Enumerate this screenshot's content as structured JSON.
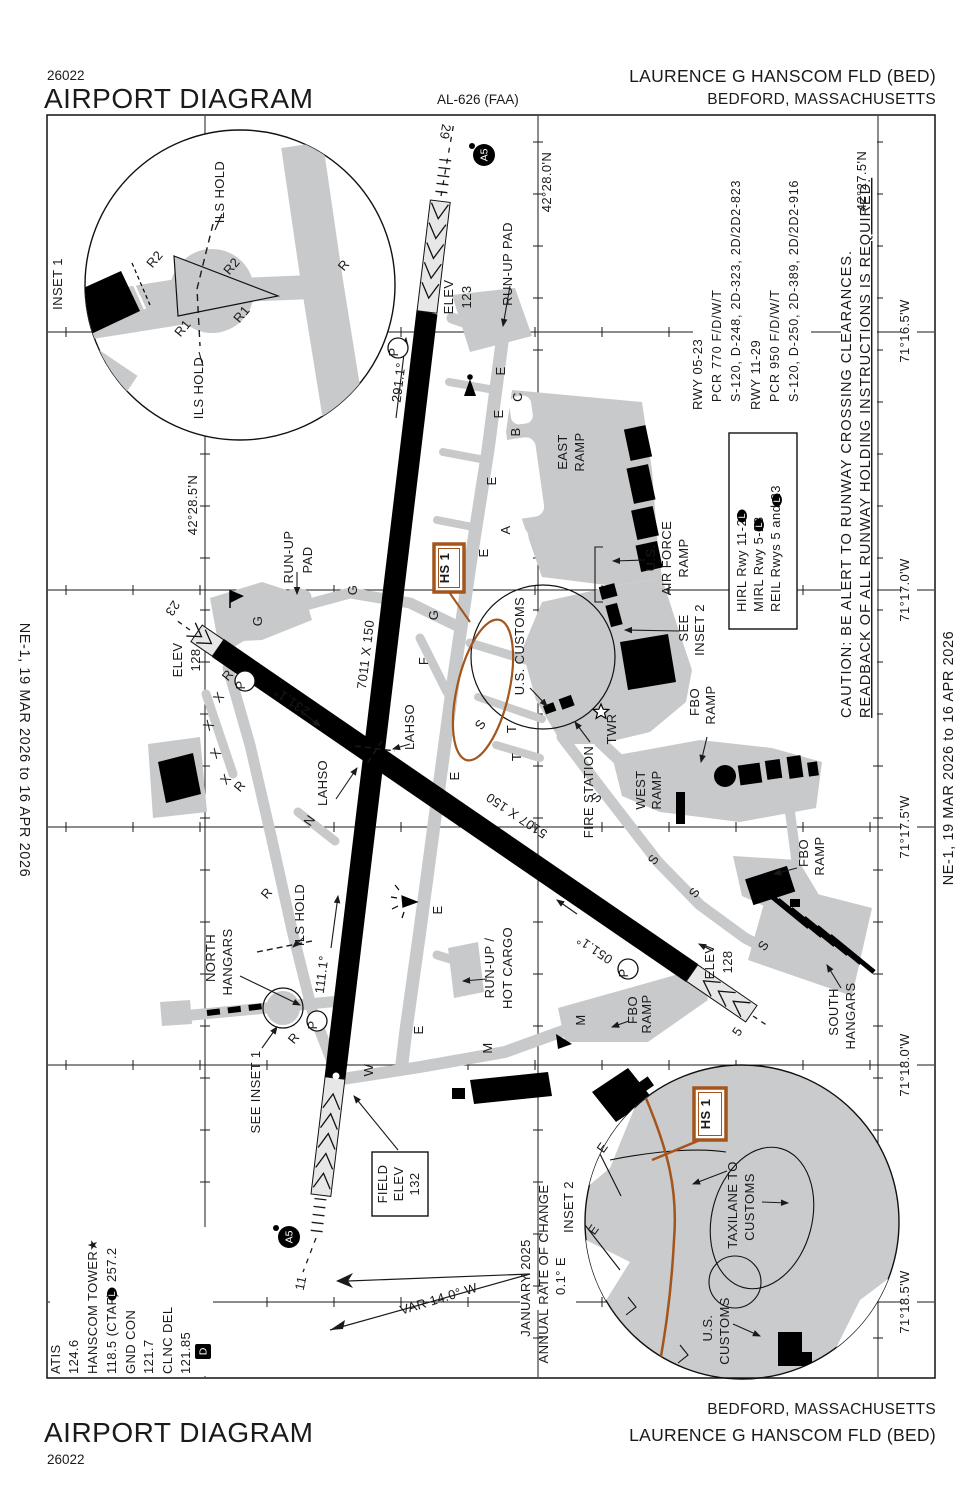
{
  "page": {
    "chart_number": "26022",
    "title": "AIRPORT DIAGRAM",
    "al_number": "AL-626 (FAA)",
    "airport_name": "LAURENCE G HANSCOM FLD (BED)",
    "city": "BEDFORD, MASSACHUSETTS",
    "edition_note": "NE-1,  19 MAR 2026  to  16 APR 2026"
  },
  "runway_data": {
    "rwy1_name": "RWY 05-23",
    "rwy1_pcr": "PCR 770 F/D/W/T",
    "rwy1_strength": "S-120, D-248, 2D-323, 2D/2D2-823",
    "rwy2_name": "RWY 11-29",
    "rwy2_pcr": "PCR 950 F/D/W/T",
    "rwy2_strength": "S-120, D-250, 2D-389, 2D/2D2-916"
  },
  "lighting_box": {
    "line1": "HIRL Rwy 11-29",
    "line2": "MIRL Rwy 5-23",
    "line3": "REIL Rwys 5 and 23"
  },
  "cautions": {
    "line1": "CAUTION: BE ALERT TO RUNWAY CROSSING CLEARANCES.",
    "line2": "READBACK OF ALL RUNWAY HOLDING INSTRUCTIONS IS REQUIRED."
  },
  "comms": {
    "atis_label": "ATIS",
    "atis_freq": "124.6",
    "tower_label": "HANSCOM TOWER★",
    "tower_freq": "118.5 (CTAF)",
    "tower_freq2": "257.2",
    "gnd_label": "GND CON",
    "gnd_freq": "121.7",
    "clnc_label": "CLNC DEL",
    "clnc_freq": "121.85"
  },
  "badges": {
    "a5": "A5",
    "l": "L",
    "d": "D",
    "p": "P"
  },
  "map_labels": [
    {
      "n": "inset1-title",
      "t": "INSET 1",
      "x": 62,
      "y": 284,
      "fs": 14
    },
    {
      "n": "ils-hold-label",
      "t": "ILS HOLD",
      "x": 224,
      "y": 192,
      "fs": 12.5
    },
    {
      "n": "ils-hold-label",
      "t": "ILS HOLD",
      "x": 203,
      "y": 388,
      "fs": 12.5
    },
    {
      "n": "taxiway-label-r2",
      "t": "R2",
      "x": 158,
      "y": 262,
      "r": -50,
      "fs": 12.5
    },
    {
      "n": "taxiway-label-r2",
      "t": "R2",
      "x": 235,
      "y": 269,
      "r": -50,
      "fs": 12.5
    },
    {
      "n": "taxiway-label-r1",
      "t": "R1",
      "x": 186,
      "y": 331,
      "r": -50,
      "fs": 12.5
    },
    {
      "n": "taxiway-label-r1",
      "t": "R1",
      "x": 245,
      "y": 317,
      "r": -50,
      "fs": 12.5
    },
    {
      "n": "taxiway-label-r",
      "t": "R",
      "x": 347,
      "y": 268,
      "r": -50,
      "fs": 12.5
    },
    {
      "n": "runway-29-number",
      "t": "29",
      "x": 441,
      "y": 131,
      "r": 100,
      "fs": 15
    },
    {
      "n": "lat-label",
      "t": "42°28.0'N",
      "x": 551,
      "y": 182,
      "fs": 12.5
    },
    {
      "n": "lat-label",
      "t": "42°28.5'N",
      "x": 197,
      "y": 505,
      "fs": 12.5
    },
    {
      "n": "lat-label",
      "t": "42°27.5'N",
      "x": 866,
      "y": 181,
      "fs": 12.5
    },
    {
      "n": "lon-label",
      "t": "71°16.5'W",
      "x": 909,
      "y": 331,
      "fs": 12.5
    },
    {
      "n": "lon-label",
      "t": "71°17.0'W",
      "x": 909,
      "y": 590,
      "fs": 12.5
    },
    {
      "n": "lon-label",
      "t": "71°17.5'W",
      "x": 909,
      "y": 827,
      "fs": 12.5
    },
    {
      "n": "lon-label",
      "t": "71°18.0'W",
      "x": 909,
      "y": 1065,
      "fs": 12.5
    },
    {
      "n": "lon-label",
      "t": "71°18.5'W",
      "x": 909,
      "y": 1302,
      "fs": 12.5
    },
    {
      "n": "elev-123-label",
      "t": "ELEV",
      "x": 453,
      "y": 297,
      "fs": 12.5
    },
    {
      "n": "elev-123-value",
      "t": "123",
      "x": 471,
      "y": 297,
      "fs": 12.5
    },
    {
      "n": "runup-pad-label",
      "t": "RUN-UP PAD",
      "x": 512,
      "y": 264,
      "fs": 12.5
    },
    {
      "n": "heading-291",
      "t": "291.1°",
      "x": 403,
      "y": 383,
      "r": -83,
      "fs": 12.5
    },
    {
      "n": "runup-pad-label",
      "t": "RUN-UP",
      "x": 293,
      "y": 557,
      "fs": 12.5
    },
    {
      "n": "runup-pad-label",
      "t": "PAD",
      "x": 312,
      "y": 560,
      "fs": 12.5
    },
    {
      "n": "runway-23-number",
      "t": "23",
      "x": 169,
      "y": 606,
      "r": 124,
      "fs": 15
    },
    {
      "n": "elev-128-label",
      "t": "ELEV",
      "x": 182,
      "y": 660,
      "fs": 12.5
    },
    {
      "n": "elev-128-value",
      "t": "128",
      "x": 200,
      "y": 660,
      "fs": 12.5
    },
    {
      "n": "taxiway-label-g",
      "t": "G",
      "x": 262,
      "y": 621
    },
    {
      "n": "taxiway-label-g",
      "t": "G",
      "x": 357,
      "y": 590
    },
    {
      "n": "taxiway-label-g",
      "t": "G",
      "x": 438,
      "y": 615
    },
    {
      "n": "runway-dimensions",
      "t": "7011 X 150",
      "x": 370,
      "y": 655,
      "r": -83,
      "fs": 13
    },
    {
      "n": "heading-231",
      "t": "231.1°",
      "x": 294,
      "y": 698,
      "r": -146,
      "fs": 12.5
    },
    {
      "n": "closed-taxiway-x",
      "t": "X",
      "x": 222,
      "y": 700,
      "r": -50,
      "fs": 12
    },
    {
      "n": "closed-taxiway-x",
      "t": "X",
      "x": 212,
      "y": 728,
      "r": -50,
      "fs": 12
    },
    {
      "n": "closed-taxiway-x",
      "t": "X",
      "x": 219,
      "y": 756,
      "r": -50,
      "fs": 12
    },
    {
      "n": "closed-taxiway-x",
      "t": "X",
      "x": 229,
      "y": 782,
      "r": -50,
      "fs": 12
    },
    {
      "n": "taxiway-label-r",
      "t": "R",
      "x": 231,
      "y": 678,
      "r": -50,
      "fs": 12.5
    },
    {
      "n": "taxiway-label-r",
      "t": "R",
      "x": 243,
      "y": 789,
      "r": -50,
      "fs": 12.5
    },
    {
      "n": "taxiway-label-r",
      "t": "R",
      "x": 270,
      "y": 896,
      "r": -50,
      "fs": 12.5
    },
    {
      "n": "taxiway-label-r",
      "t": "R",
      "x": 297,
      "y": 1041,
      "r": -50,
      "fs": 12.5
    },
    {
      "n": "taxiway-label-e",
      "t": "E",
      "x": 505,
      "y": 371
    },
    {
      "n": "taxiway-label-c",
      "t": "C",
      "x": 522,
      "y": 397
    },
    {
      "n": "taxiway-label-e",
      "t": "E",
      "x": 503,
      "y": 414
    },
    {
      "n": "taxiway-label-b",
      "t": "B",
      "x": 520,
      "y": 432
    },
    {
      "n": "taxiway-label-e",
      "t": "E",
      "x": 496,
      "y": 481
    },
    {
      "n": "taxiway-label-a",
      "t": "A",
      "x": 510,
      "y": 530
    },
    {
      "n": "taxiway-label-e",
      "t": "E",
      "x": 488,
      "y": 553
    },
    {
      "n": "taxiway-label-f",
      "t": "F",
      "x": 428,
      "y": 661
    },
    {
      "n": "taxiway-label-e",
      "t": "E",
      "x": 459,
      "y": 776
    },
    {
      "n": "taxiway-label-n",
      "t": "N",
      "x": 313,
      "y": 823,
      "r": -55
    },
    {
      "n": "taxiway-label-t",
      "t": "T",
      "x": 516,
      "y": 729
    },
    {
      "n": "taxiway-label-t",
      "t": "T",
      "x": 521,
      "y": 757
    },
    {
      "n": "taxiway-label-s",
      "t": "S",
      "x": 484,
      "y": 727,
      "r": -55
    },
    {
      "n": "taxiway-label-s",
      "t": "S",
      "x": 600,
      "y": 800,
      "r": -55
    },
    {
      "n": "taxiway-label-s",
      "t": "S",
      "x": 657,
      "y": 862,
      "r": -55
    },
    {
      "n": "taxiway-label-s",
      "t": "S",
      "x": 698,
      "y": 895,
      "r": -55
    },
    {
      "n": "taxiway-label-s",
      "t": "S",
      "x": 767,
      "y": 948,
      "r": -55
    },
    {
      "n": "taxiway-label-e",
      "t": "E",
      "x": 442,
      "y": 910
    },
    {
      "n": "taxiway-label-e",
      "t": "E",
      "x": 423,
      "y": 1030
    },
    {
      "n": "taxiway-label-m",
      "t": "M",
      "x": 492,
      "y": 1048
    },
    {
      "n": "taxiway-label-m",
      "t": "M",
      "x": 585,
      "y": 1020
    },
    {
      "n": "taxiway-label-w",
      "t": "W",
      "x": 373,
      "y": 1070
    },
    {
      "n": "east-ramp-label",
      "t": "EAST",
      "x": 567,
      "y": 452
    },
    {
      "n": "east-ramp-label",
      "t": "RAMP",
      "x": 584,
      "y": 452
    },
    {
      "n": "us-air-force-ramp-label",
      "t": "U.S.",
      "x": 655,
      "y": 558
    },
    {
      "n": "us-air-force-ramp-label",
      "t": "AIR FORCE",
      "x": 671,
      "y": 558
    },
    {
      "n": "us-air-force-ramp-label",
      "t": "RAMP",
      "x": 688,
      "y": 558
    },
    {
      "n": "see-inset2-label",
      "t": "SEE",
      "x": 688,
      "y": 628
    },
    {
      "n": "see-inset2-label",
      "t": "INSET 2",
      "x": 704,
      "y": 630
    },
    {
      "n": "us-customs-label",
      "t": "U.S. CUSTOMS",
      "x": 524,
      "y": 646
    },
    {
      "n": "hotspot-hs1-label",
      "t": "HS 1",
      "x": 449,
      "y": 568,
      "c": "#A3551C",
      "fs": 13,
      "b": 1
    },
    {
      "n": "hotspot-hs1-label",
      "t": "HS 1",
      "x": 710,
      "y": 1114,
      "c": "#A3551C",
      "fs": 13,
      "b": 1
    },
    {
      "n": "lahso-label",
      "t": "LAHSO",
      "x": 414,
      "y": 727
    },
    {
      "n": "lahso-label",
      "t": "LAHSO",
      "x": 327,
      "y": 783
    },
    {
      "n": "twr-label",
      "t": "TWR",
      "x": 616,
      "y": 729
    },
    {
      "n": "fire-station-label",
      "t": "FIRE STATION",
      "x": 593,
      "y": 792
    },
    {
      "n": "west-ramp-label",
      "t": "WEST",
      "x": 645,
      "y": 790
    },
    {
      "n": "west-ramp-label",
      "t": "RAMP",
      "x": 661,
      "y": 790
    },
    {
      "n": "fbo-ramp-label",
      "t": "FBO",
      "x": 699,
      "y": 702
    },
    {
      "n": "fbo-ramp-label",
      "t": "RAMP",
      "x": 715,
      "y": 705
    },
    {
      "n": "fbo-ramp-label",
      "t": "FBO",
      "x": 808,
      "y": 853
    },
    {
      "n": "fbo-ramp-label",
      "t": "RAMP",
      "x": 824,
      "y": 856
    },
    {
      "n": "fbo-ramp-label",
      "t": "FBO",
      "x": 637,
      "y": 1010
    },
    {
      "n": "fbo-ramp-label",
      "t": "RAMP",
      "x": 651,
      "y": 1014
    },
    {
      "n": "south-hangars-label",
      "t": "SOUTH",
      "x": 838,
      "y": 1012
    },
    {
      "n": "south-hangars-label",
      "t": "HANGARS",
      "x": 855,
      "y": 1016
    },
    {
      "n": "north-hangars-label",
      "t": "NORTH",
      "x": 215,
      "y": 958
    },
    {
      "n": "north-hangars-label",
      "t": "HANGARS",
      "x": 232,
      "y": 962
    },
    {
      "n": "ils-hold-label",
      "t": "ILS HOLD",
      "x": 304,
      "y": 915,
      "fs": 12.5
    },
    {
      "n": "heading-111",
      "t": "111.1°",
      "x": 326,
      "y": 975,
      "r": -83,
      "fs": 12.5
    },
    {
      "n": "see-inset1-label",
      "t": "SEE INSET 1",
      "x": 260,
      "y": 1092
    },
    {
      "n": "runway-dimensions",
      "t": "5107 X 150",
      "x": 519,
      "y": 812,
      "r": -146,
      "fs": 13
    },
    {
      "n": "heading-051",
      "t": "051.1°",
      "x": 597,
      "y": 946,
      "r": -146,
      "fs": 12.5
    },
    {
      "n": "runup-hot-cargo-label",
      "t": "RUN-UP /",
      "x": 494,
      "y": 968
    },
    {
      "n": "runup-hot-cargo-label",
      "t": "HOT CARGO",
      "x": 512,
      "y": 968
    },
    {
      "n": "elev-128-label",
      "t": "ELEV",
      "x": 714,
      "y": 962,
      "fs": 12.5
    },
    {
      "n": "elev-128-value",
      "t": "128",
      "x": 732,
      "y": 962,
      "fs": 12.5
    },
    {
      "n": "runway-5-number",
      "t": "5",
      "x": 741,
      "y": 1034,
      "r": -56,
      "fs": 15
    },
    {
      "n": "runway-11-number",
      "t": "11",
      "x": 305,
      "y": 1284,
      "r": -78,
      "fs": 15
    },
    {
      "n": "field-elev-label",
      "t": "FIELD",
      "x": 387,
      "y": 1184,
      "fs": 12.5
    },
    {
      "n": "field-elev-label",
      "t": "ELEV",
      "x": 403,
      "y": 1184,
      "fs": 12.5
    },
    {
      "n": "field-elev-value",
      "t": "132",
      "x": 419,
      "y": 1184,
      "fs": 12.5
    },
    {
      "n": "variation-label",
      "t": "VAR 14.0°  W",
      "x": 440,
      "y": 1303,
      "r": -17,
      "fs": 13
    },
    {
      "n": "variation-date",
      "t": "JANUARY 2025",
      "x": 530,
      "y": 1288
    },
    {
      "n": "variation-rate-label",
      "t": "ANNUAL RATE OF CHANGE",
      "x": 548,
      "y": 1274
    },
    {
      "n": "variation-rate",
      "t": "0.1° E",
      "x": 565,
      "y": 1276
    },
    {
      "n": "inset2-title",
      "t": "INSET 2",
      "x": 573,
      "y": 1207,
      "fs": 14
    },
    {
      "n": "taxilane-customs-label",
      "t": "TAXILANE TO",
      "x": 737,
      "y": 1205
    },
    {
      "n": "taxilane-customs-label",
      "t": "CUSTOMS",
      "x": 754,
      "y": 1207
    },
    {
      "n": "us-customs-label",
      "t": "U.S.",
      "x": 712,
      "y": 1328
    },
    {
      "n": "us-customs-label",
      "t": "CUSTOMS",
      "x": 729,
      "y": 1331
    },
    {
      "n": "taxiway-label-e",
      "t": "E",
      "x": 606,
      "y": 1150,
      "r": -55
    },
    {
      "n": "taxiway-label-e",
      "t": "E",
      "x": 597,
      "y": 1232,
      "r": -55
    },
    {
      "n": "parking-p",
      "t": "P",
      "x": 398,
      "y": 352,
      "fs": 12
    },
    {
      "n": "parking-p",
      "t": "P",
      "x": 245,
      "y": 685,
      "fs": 12
    },
    {
      "n": "parking-p",
      "t": "P",
      "x": 317,
      "y": 1025,
      "fs": 12
    },
    {
      "n": "parking-p",
      "t": "P",
      "x": 628,
      "y": 973,
      "fs": 12
    }
  ]
}
